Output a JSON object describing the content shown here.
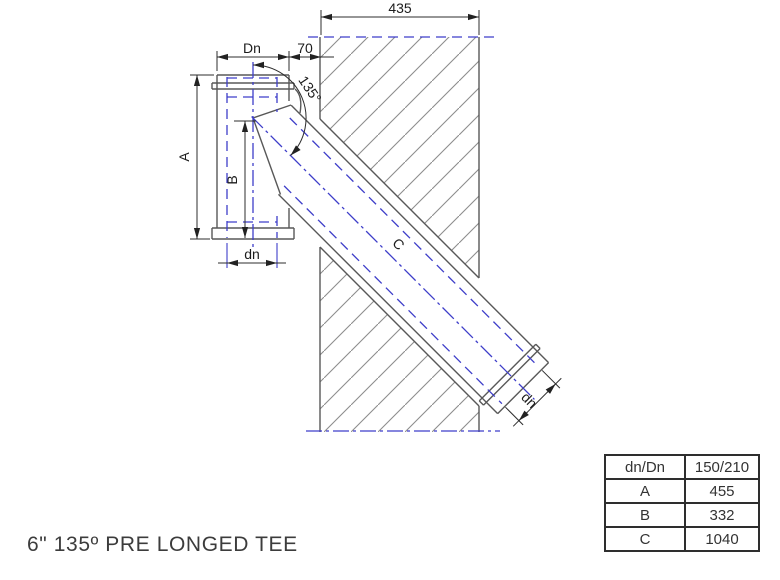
{
  "title": "6\" 135º PRE LONGED TEE",
  "drawing": {
    "labels": {
      "dim_435": "435",
      "dim_Dn": "Dn",
      "dim_70": "70",
      "dim_A": "A",
      "dim_B": "B",
      "dim_dn_bottom": "dn",
      "angle_135": "135°",
      "dim_C": "C",
      "dim_dn_end": "dn"
    },
    "colors": {
      "object_line": "#585858",
      "hidden_line_blue": "#3e3ec9",
      "dimension_line": "#2d2d2d",
      "hatch": "#8d8d8d"
    }
  },
  "table": {
    "rows": [
      {
        "label": "dn/Dn",
        "value": "150/210"
      },
      {
        "label": "A",
        "value": "455"
      },
      {
        "label": "B",
        "value": "332"
      },
      {
        "label": "C",
        "value": "1040"
      }
    ]
  }
}
